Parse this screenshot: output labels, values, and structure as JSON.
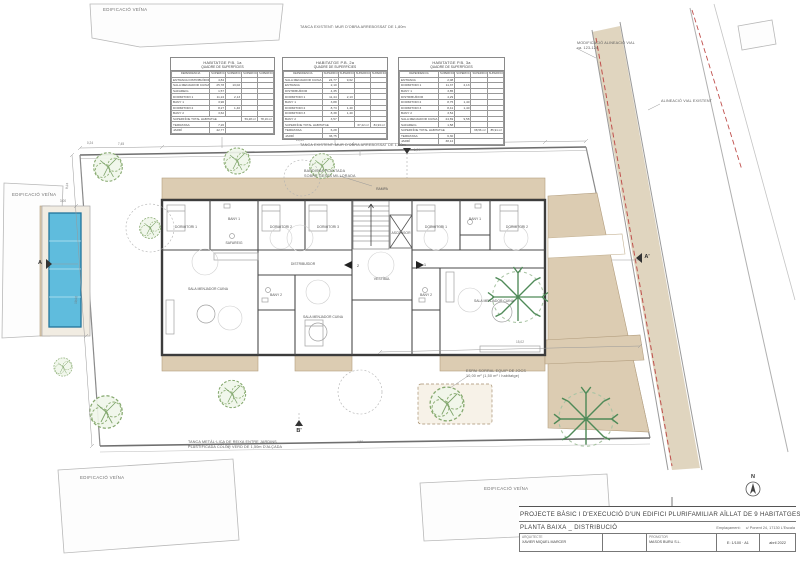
{
  "title_block": {
    "title": "PROJECTE  BÀSIC  I  D'EXECUCIÓ  D'UN  EDIFICI  PLURIFAMILIAR  AÏLLAT  DE  9  HABITATGES  I  PISCINA",
    "sheet_number": ".04",
    "subtitle": "PLANTA  BAIXA  _  DISTRIBUCIÓ",
    "emplacament_label": "Emplaçament:",
    "emplacament": "c/ Ponent 24,  17130  L'Escala",
    "architect_label": "ARQUITECTE",
    "architect": "XAVIER MIQUEL MARCER",
    "promoter_label": "PROMOTOR",
    "promoter": "MASOS BURU S.L.",
    "scale": "E: 1/100 · A1",
    "date": "abril 2022"
  },
  "tables": [
    {
      "title": "HABITATGE  P.B.  1a",
      "subtitle": "QUADRE  DE  SUPERFÍCIES",
      "columns": [
        "DEPENDÈNCIA",
        "SUPERFÍCIE ÚTIL (m²)",
        "SUPERFÍCIE VENTILACIÓ",
        "SUPERFÍCIE ÚTIL TOTAL",
        "SUPERFÍCIE CONSTRUÏDA TOTAL"
      ],
      "rows": [
        [
          "ENTRADA DISTRIBUÏDOR",
          "4,84",
          ""
        ],
        [
          "SALA MENJADOR CUINA",
          "25,78",
          "13,02"
        ],
        [
          "SAFAREIG",
          "1,57",
          ""
        ],
        [
          "DORMITORI 1",
          "11,24",
          "2,13"
        ],
        [
          "BANY 1",
          "3,96",
          ""
        ],
        [
          "DORMITORI 2",
          "8,27",
          "1,40"
        ],
        [
          "BANY 2",
          "3,62",
          ""
        ]
      ],
      "total_label": "SUPERFÍCIE TOTAL HABITATGE",
      "total_util": "59,28 m²",
      "total_built": "78,16 m²",
      "extras": [
        [
          "TERRASSA",
          "7,26"
        ],
        [
          "JARDÍ",
          "42,77"
        ]
      ]
    },
    {
      "title": "HABITATGE  P.B.  2a",
      "subtitle": "QUADRE  DE  SUPERFÍCIES",
      "columns": [
        "DEPENDÈNCIA",
        "SUPERFÍCIE ÚTIL (m²)",
        "SUPERFÍCIE VENTILACIÓ",
        "SUPERFÍCIE ÚTIL TOTAL",
        "SUPERFÍCIE CONSTRUÏDA TOTAL"
      ],
      "rows": [
        [
          "SALA MENJADOR CUINA",
          "24,77",
          "9,62"
        ],
        [
          "ENTRADA",
          "2,10",
          ""
        ],
        [
          "DISTRIBUÏDOR",
          "4,35",
          ""
        ],
        [
          "DORMITORI 1",
          "11,44",
          "2,13"
        ],
        [
          "BANY 1",
          "3,88",
          ""
        ],
        [
          "DORMITORI 2",
          "8,73",
          "1,40"
        ],
        [
          "DORMITORI 3",
          "8,38",
          "1,40"
        ],
        [
          "BANY 2",
          "3,57",
          ""
        ]
      ],
      "total_label": "SUPERFÍCIE TOTAL HABITATGE",
      "total_util": "67,22 m²",
      "total_built": "84,93 m²",
      "extras": [
        [
          "TERRASSA",
          "6,28"
        ],
        [
          "JARDÍ",
          "36,75"
        ]
      ]
    },
    {
      "title": "HABITATGE  P.B.  3a",
      "subtitle": "QUADRE  DE  SUPERFÍCIES",
      "columns": [
        "DEPENDÈNCIA",
        "SUPERFÍCIE ÚTIL (m²)",
        "SUPERFÍCIE VENTILACIÓ",
        "SUPERFÍCIE ÚTIL TOTAL",
        "SUPERFÍCIE CONSTRUÏDA TOTAL"
      ],
      "rows": [
        [
          "ENTRADA",
          "2,08",
          ""
        ],
        [
          "DORMITORI 1",
          "11,37",
          "2,13"
        ],
        [
          "BANY 1",
          "3,85",
          ""
        ],
        [
          "DISTRIBUÏDOR",
          "4,29",
          ""
        ],
        [
          "DORMITORI 2",
          "8,75",
          "1,40"
        ],
        [
          "DORMITORI 3",
          "8,41",
          "1,40"
        ],
        [
          "BANY 2",
          "3,54",
          ""
        ],
        [
          "SALA MENJADOR CUINA",
          "24,69",
          "9,58"
        ],
        [
          "SAFAREIG",
          "1,58",
          ""
        ]
      ],
      "total_label": "SUPERFÍCIE TOTAL HABITATGE",
      "total_util": "68,56 m²",
      "total_built": "85,91 m²",
      "extras": [
        [
          "TERRASSA",
          "6,30"
        ],
        [
          "JARDÍ",
          "38,12"
        ]
      ]
    }
  ],
  "annotations": {
    "items": [
      {
        "name": "label-edificacio-veina-1",
        "cls": "big",
        "x": 103,
        "y": 7,
        "lines": [
          "EDIFICACIÓ VEÏNA"
        ]
      },
      {
        "name": "label-edificacio-veina-2",
        "cls": "big",
        "x": 12,
        "y": 192,
        "lines": [
          "EDIFICACIÓ VEÏNA"
        ]
      },
      {
        "name": "label-edificacio-veina-3",
        "cls": "big",
        "x": 80,
        "y": 475,
        "lines": [
          "EDIFICACIÓ VEÏNA"
        ]
      },
      {
        "name": "label-edificacio-veina-4",
        "cls": "big",
        "x": 484,
        "y": 486,
        "lines": [
          "EDIFICACIÓ VEÏNA"
        ]
      },
      {
        "name": "label-tanca-existent-1",
        "cls": "",
        "x": 300,
        "y": 25,
        "lines": [
          "TANCA EXISTENT: MUR D'OBRA ARREBOSSAT DE 1,80m"
        ]
      },
      {
        "name": "label-tanca-existent-2",
        "cls": "",
        "x": 300,
        "y": 143,
        "lines": [
          "TANCA EXISTENT: MUR D'OBRA ARREBOSSAT DE 1,80m"
        ]
      },
      {
        "name": "label-modificacio-alineacio",
        "cls": "",
        "x": 577,
        "y": 41,
        "lines": [
          "MODIFICACIÓ ALINEACIÓ VIAL",
          "ca. 123-124"
        ]
      },
      {
        "name": "label-alineacio-vial",
        "cls": "",
        "x": 661,
        "y": 99,
        "lines": [
          "ALINEACIÓ VIAL EXISTENT"
        ]
      },
      {
        "name": "label-bardissa",
        "cls": "",
        "x": 304,
        "y": 169,
        "lines": [
          "BARDISSA PLANTADA",
          "SOBRE GESPA MILLORADA"
        ]
      },
      {
        "name": "label-tanca-metallica",
        "cls": "",
        "x": 188,
        "y": 440,
        "lines": [
          "TANCA METÀL·LICA DE REIXA ENTRE JARDINS",
          "PLASTIFICADA COLOR VERD DE 1,50m D'ALÇADA"
        ]
      },
      {
        "name": "label-sorral",
        "cls": "",
        "x": 466,
        "y": 369,
        "lines": [
          "ESPAI SORRAL EQUIP DE JOCS",
          "10,00 m²  (1,50 m² / habitatge)"
        ]
      }
    ]
  },
  "plan": {
    "rooms": [
      {
        "t": "DORMITORI 1",
        "x": 186,
        "y": 228
      },
      {
        "t": "BANY 1",
        "x": 234,
        "y": 220
      },
      {
        "t": "SAFAREIG",
        "x": 234,
        "y": 244
      },
      {
        "t": "SALA MENJADOR CUINA",
        "x": 208,
        "y": 290
      },
      {
        "t": "DORMITORI 2",
        "x": 281,
        "y": 228
      },
      {
        "t": "DORMITORI 3",
        "x": 328,
        "y": 228
      },
      {
        "t": "DISTRIBUÏDOR",
        "x": 303,
        "y": 265
      },
      {
        "t": "BANY 2",
        "x": 276,
        "y": 296
      },
      {
        "t": "SALA MENJADOR CUINA",
        "x": 323,
        "y": 318
      },
      {
        "t": "VESTÍBUL",
        "x": 382,
        "y": 280
      },
      {
        "t": "ASCENSOR",
        "x": 401,
        "y": 234
      },
      {
        "t": "RAMPA",
        "x": 382,
        "y": 190
      },
      {
        "t": "DORMITORI 1",
        "x": 436,
        "y": 228
      },
      {
        "t": "BANY 1",
        "x": 475,
        "y": 220
      },
      {
        "t": "DORMITORI 2",
        "x": 517,
        "y": 228
      },
      {
        "t": "BANY 2",
        "x": 426,
        "y": 296
      },
      {
        "t": "SALA MENJADOR CUINA",
        "x": 494,
        "y": 302
      }
    ],
    "dimensions": [
      {
        "t": "0,24",
        "x": 90,
        "y": 144
      },
      {
        "t": "7,45",
        "x": 121,
        "y": 145
      },
      {
        "t": "24,30",
        "x": 300,
        "y": 141
      },
      {
        "t": "6,80",
        "x": 500,
        "y": 139
      },
      {
        "t": "1,74",
        "x": 417,
        "y": 151
      },
      {
        "t": "8,24",
        "x": 68,
        "y": 186,
        "r": -86
      },
      {
        "t": "19,02",
        "x": 77,
        "y": 300,
        "r": -86
      },
      {
        "t": "15,02",
        "x": 520,
        "y": 343
      },
      {
        "t": "3,00",
        "x": 63,
        "y": 202
      },
      {
        "t": "4,50",
        "x": 360,
        "y": 443
      }
    ],
    "markers": [
      {
        "t": "A",
        "x": 40,
        "y": 264
      },
      {
        "t": "A'",
        "x": 647,
        "y": 258
      },
      {
        "t": "B",
        "x": 407,
        "y": 143
      },
      {
        "t": "B'",
        "x": 299,
        "y": 432
      },
      {
        "t": "N",
        "x": 753,
        "y": 478
      }
    ],
    "entry_numbers": [
      {
        "t": "2",
        "x": 358,
        "y": 267
      },
      {
        "t": "1",
        "x": 425,
        "y": 266
      }
    ]
  }
}
